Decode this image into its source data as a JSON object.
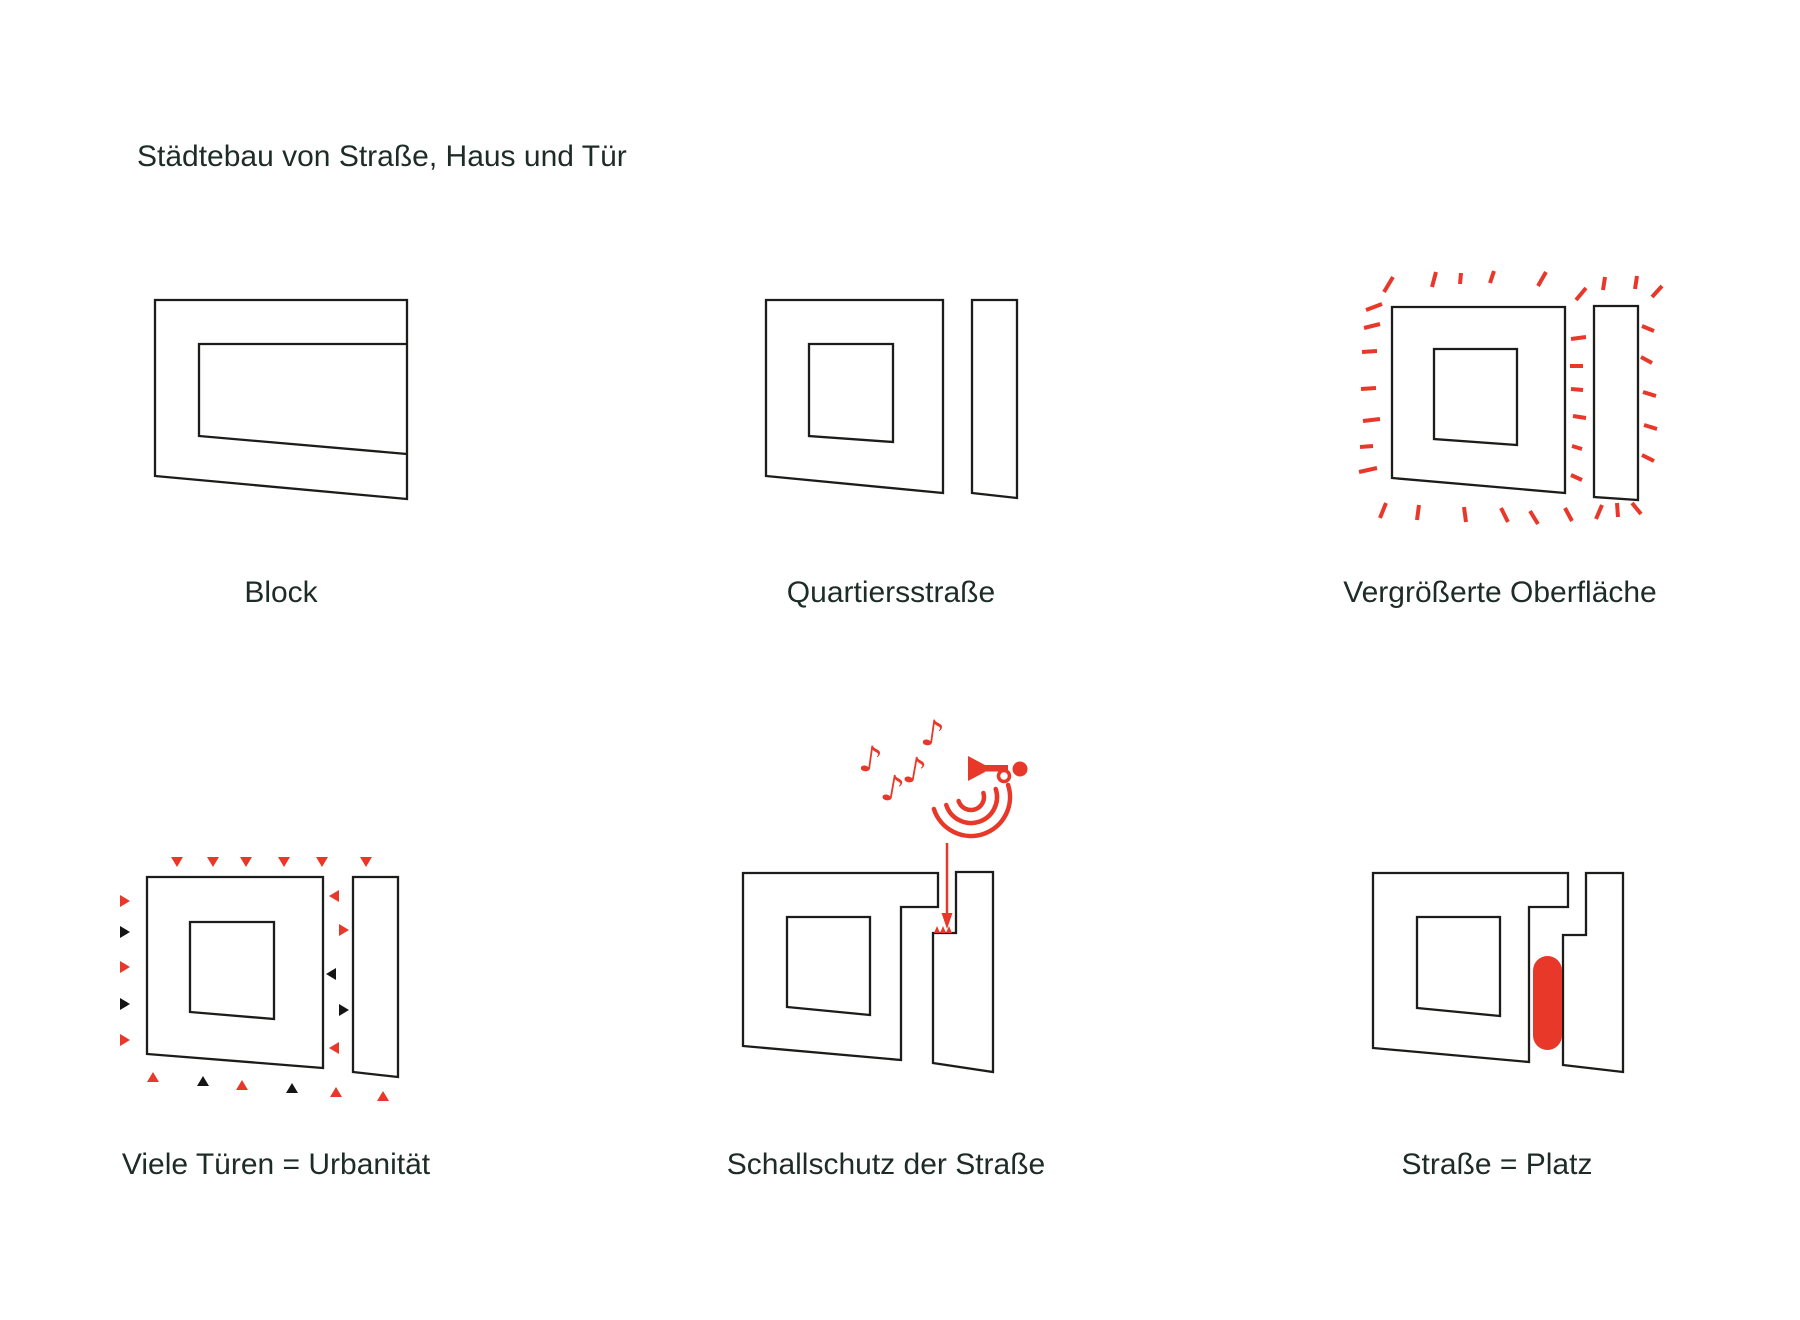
{
  "title": "Städtebau von Straße, Haus und Tür",
  "diagrams": [
    {
      "id": "block",
      "label": "Block"
    },
    {
      "id": "quartiersstrasse",
      "label": "Quartiersstraße"
    },
    {
      "id": "vergroesserte-oberflaeche",
      "label": "Vergrößerte Oberfläche"
    },
    {
      "id": "viele-tueren",
      "label": "Viele Türen = Urbanität"
    },
    {
      "id": "schallschutz",
      "label": "Schallschutz der Straße"
    },
    {
      "id": "strasse-platz",
      "label": "Straße = Platz"
    }
  ],
  "glyphs": {
    "music_note": "♪"
  },
  "icons": {
    "music_note": "music-note-icon",
    "horn": "horn-icon",
    "sound_waves": "sound-wave-arcs-icon",
    "noise_arrow": "noise-arrow-icon",
    "doors_red": "door-triangle-red",
    "doors_black": "door-triangle-black",
    "surface_dashes": "radiating-dash",
    "plaza": "plaza-capsule"
  },
  "colors": {
    "accent_red": "#e8382a",
    "line": "#1c1c1a",
    "text": "#1e2c28",
    "background": "#ffffff"
  }
}
